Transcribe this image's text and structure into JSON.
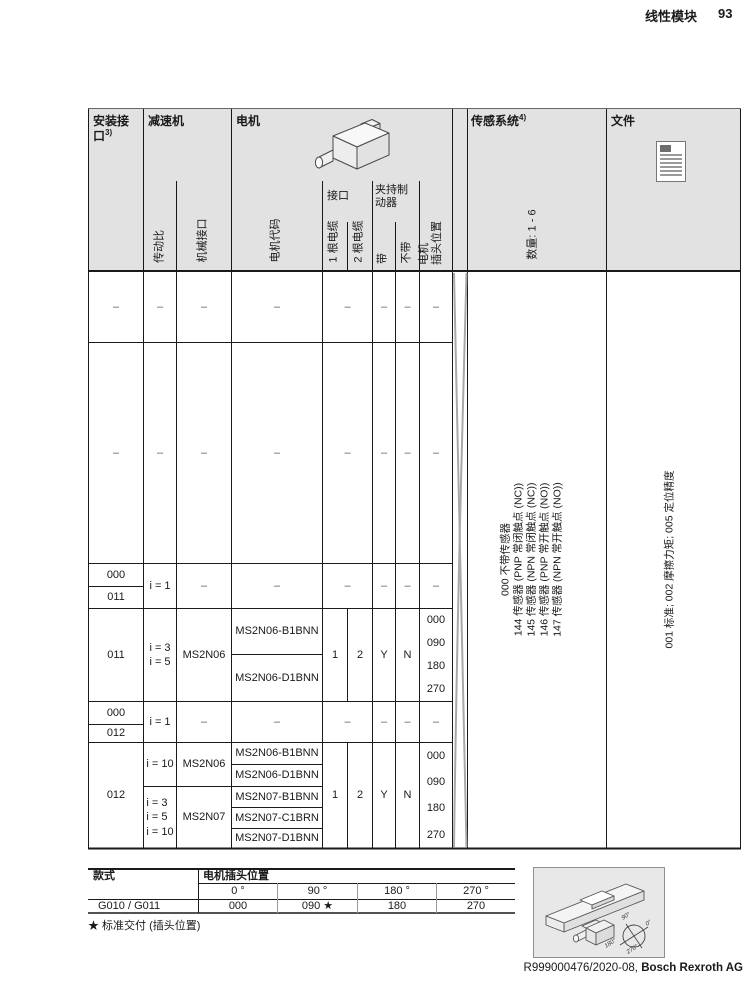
{
  "page": {
    "title": "线性模块",
    "page_number": "93",
    "footer_ref": "R999000476/2020-08,",
    "footer_company": "Bosch Rexroth AG"
  },
  "header": {
    "mount_line1": "安装接",
    "mount_line2": "口",
    "mount_sup": "3)",
    "gearbox": "减速机",
    "motor": "电机",
    "sensor": "传感系统",
    "sensor_sup": "4)",
    "doc": "文件",
    "ratio": "传动比",
    "mech_interface": "机械接口",
    "motor_code": "电机代码",
    "interface": "接口",
    "cable1": "1 根电缆",
    "cable2": "2 根电缆",
    "brake_line1": "夹持制",
    "brake_line2": "动器",
    "with_brake": "带",
    "without_brake": "不带",
    "plug_line1": "电机",
    "plug_line2": "插头位置",
    "sensor_qty": "数量: 1 - 6"
  },
  "body": {
    "dash": "–",
    "g3": {
      "mount_a": "000",
      "mount_b": "011",
      "ratio_ab": "i = 1",
      "mount": "011",
      "ratio": [
        "i = 3",
        "i = 5"
      ],
      "mech": "MS2N06",
      "codes": [
        "MS2N06-B1BNN",
        "MS2N06-D1BNN"
      ],
      "cable1": "1",
      "cable2": "2",
      "with_brake": "Y",
      "without_brake": "N",
      "plug_positions": [
        "000",
        "090",
        "180",
        "270"
      ]
    },
    "g4": {
      "mount_a": "000",
      "mount_b": "012",
      "ratio_ab": "i = 1",
      "mount": "012",
      "ratio_top": "i = 10",
      "ratio_bottom": [
        "i = 3",
        "i = 5",
        "i = 10"
      ],
      "mech_top": "MS2N06",
      "mech_bottom": "MS2N07",
      "codes": [
        "MS2N06-B1BNN",
        "MS2N06-D1BNN",
        "MS2N07-B1BNN",
        "MS2N07-C1BRN",
        "MS2N07-D1BNN"
      ],
      "cable1": "1",
      "cable2": "2",
      "with_brake": "Y",
      "without_brake": "N",
      "plug_positions": [
        "000",
        "090",
        "180",
        "270"
      ]
    }
  },
  "sensor_options": [
    "000 不带传感器",
    "144 传感器 (PNP 常闭触点 (NC))",
    "145 传感器 (NPN 常闭触点 (NC))",
    "146 传感器 (PNP 常开触点 (NO))",
    "147 传感器 (NPN 常开触点 (NO))"
  ],
  "doc_options": "001 标准; 002 摩擦力矩; 005 定位精度",
  "bottom_table": {
    "style_label": "款式",
    "plug_label": "电机插头位置",
    "degrees": [
      "0 °",
      "90 °",
      "180 °",
      "270 °"
    ],
    "style_value": "G010 / G011",
    "values": [
      "000",
      "090 ★",
      "180",
      "270"
    ],
    "footnote": "★ 标准交付 (插头位置)"
  },
  "diagram": {
    "angle_0": "0°",
    "angle_90": "90°",
    "angle_180": "180°",
    "angle_270": "270°"
  },
  "colors": {
    "header_bg": "#e2e2e2",
    "diagram_bg": "#e8e8e8",
    "line": "#1a1a1a"
  }
}
